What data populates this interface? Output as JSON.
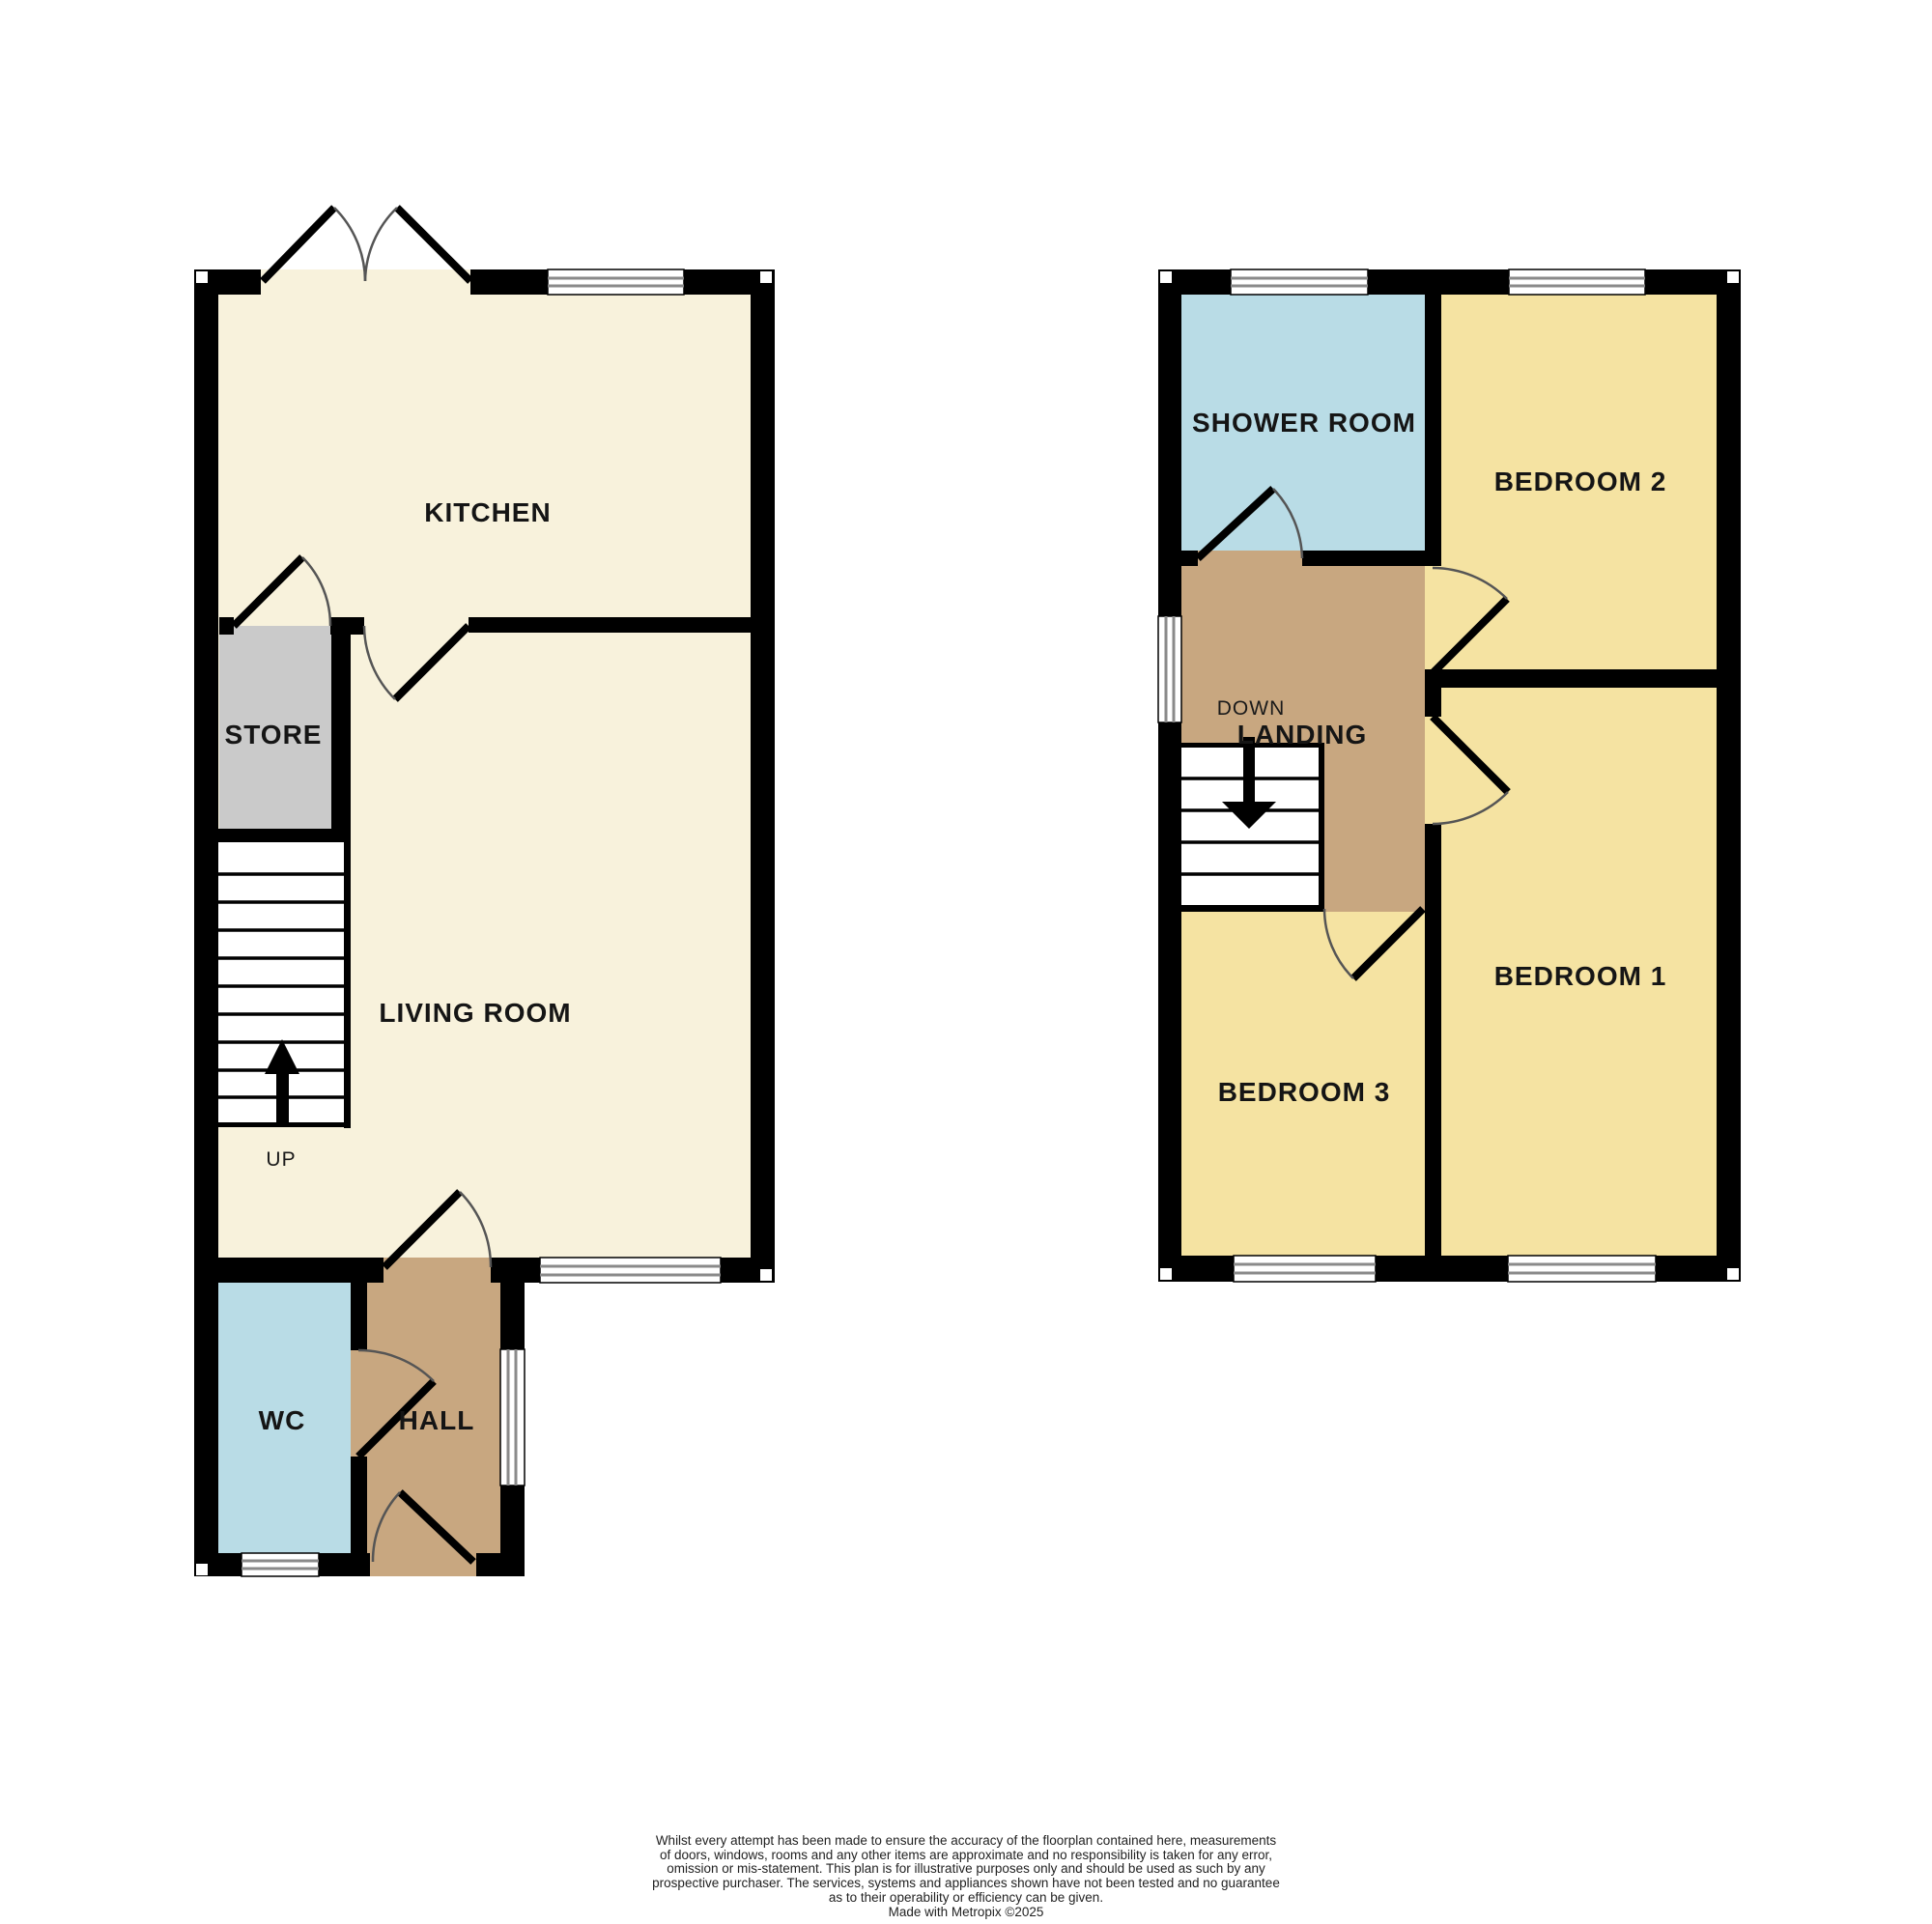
{
  "colors": {
    "cream": "#F8F2DC",
    "yellow": "#F5E3A2",
    "blue": "#B9DCE6",
    "tan": "#C8A780",
    "grey": "#CACACA",
    "wall": "#000000",
    "label": "#151515"
  },
  "ground_floor": {
    "kitchen": "KITCHEN",
    "store": "STORE",
    "living_room": "LIVING ROOM",
    "wc": "WC",
    "hall": "HALL",
    "up": "UP"
  },
  "first_floor": {
    "shower_room": "SHOWER ROOM",
    "bedroom2": "BEDROOM 2",
    "landing": "LANDING",
    "down": "DOWN",
    "bedroom3": "BEDROOM 3",
    "bedroom1": "BEDROOM 1"
  },
  "disclaimer": {
    "lines": [
      "Whilst every attempt has been made to ensure the accuracy of the floorplan contained here, measurements",
      "of doors, windows, rooms and any other items are approximate and no responsibility is taken for any error,",
      "omission or mis-statement. This plan is for illustrative purposes only and should be used as such by any",
      "prospective purchaser. The services, systems and appliances shown have not been tested and no guarantee",
      "as to their operability or efficiency can be given.",
      "Made with Metropix ©2025"
    ]
  }
}
